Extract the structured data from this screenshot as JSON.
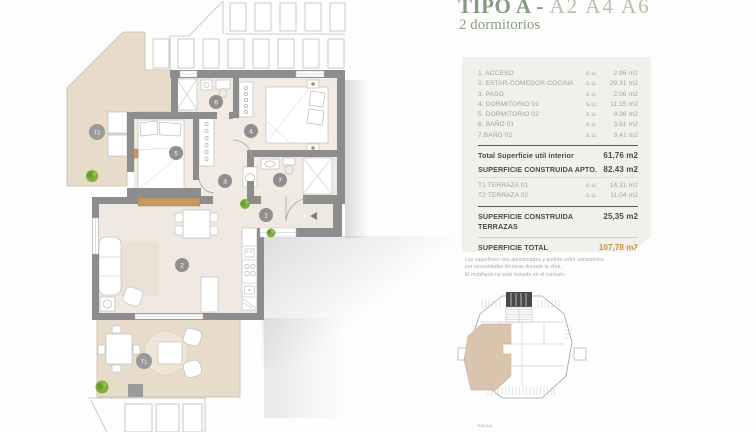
{
  "header": {
    "title_main": "TIPO A -",
    "title_variants": "A2 A4 A6",
    "subtitle": "2 dormitorios"
  },
  "panel": {
    "su_label": "s.u.",
    "rooms": [
      {
        "name": "1. ACCESO",
        "value": "2.96 m2"
      },
      {
        "name": "2. ESTAR-COMEDOR-COCINA",
        "value": "29.31 m2"
      },
      {
        "name": "3. PASO",
        "value": "2.06 m2"
      },
      {
        "name": "4. DORMITORIO 01",
        "value": "11.15 m2"
      },
      {
        "name": "5. DORMITORIO 02",
        "value": "9.36 m2"
      },
      {
        "name": "6. BAÑO 01",
        "value": "3.51 m2"
      },
      {
        "name": "7.BAÑO 02",
        "value": "3.41 m2"
      }
    ],
    "total_util": {
      "label": "Total Superficie util interior",
      "value": "61,76 m2"
    },
    "construida_apto": {
      "label": "SUPERFICIE CONSTRUIDA APTO.",
      "value": "82.43 m2"
    },
    "terrazas": [
      {
        "name": "T1 TERRAZA 01",
        "value": "14,31 m2"
      },
      {
        "name": "T2 TERRAZA 02",
        "value": "11,04 m2"
      }
    ],
    "construida_terrazas": {
      "label": "SUPERFICIE CONSTRUIDA TERRAZAS",
      "value": "25,35 m2"
    },
    "total_apartamento": {
      "label": "SUPERFICIE TOTAL APARTAMENTO",
      "value": "107,78 m2"
    }
  },
  "disclaimer": {
    "line1": "Las superficies son aproximadas y podrán sufrir variaciones",
    "line2": "por necesidades técnicas durante la obra.",
    "line3": "El mobiliario no está incluido en el contrato."
  },
  "keyplan": {
    "caption": "ESCA A"
  },
  "plan": {
    "room_labels": {
      "r1": "1",
      "r2": "2",
      "r3": "3",
      "r4": "4",
      "r5": "5",
      "r6": "6",
      "r7": "7",
      "t1": "T1",
      "t2": "T2"
    }
  },
  "colors": {
    "accent_orange": "#c9923e",
    "title_green": "#87997e",
    "terrace_tan": "#e7dcc9",
    "wall_gray": "#8d8d8d",
    "keyplan_highlight": "#d8c2a9"
  }
}
